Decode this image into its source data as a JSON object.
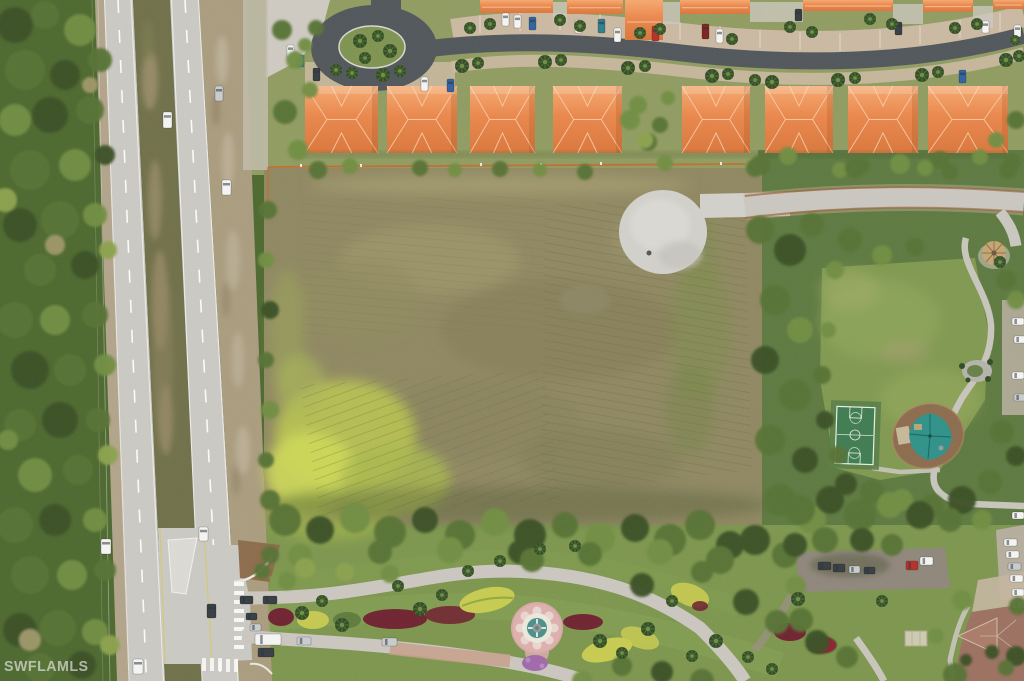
{
  "watermark": {
    "text": "SWFLAMLS"
  },
  "palette": {
    "forest_base": "#4c672f",
    "topland_base": "#8e9a60",
    "lot_base": "#8d8660",
    "park_base": "#5c7840",
    "bottom_base": "#7b944d",
    "hwy": "#c9c7c1",
    "lane": "#ffffff",
    "asphalt": "#50555a",
    "gravel": "#a89a7d",
    "shoulder": "#b0a289",
    "median_veg": "#6e6e49",
    "median_tan": "#a3936f",
    "apron": "#c9b7a0",
    "pave_light": "#ccc8c0",
    "roof_base": "#e8854b",
    "roof_light": "#f4a76e",
    "roof_dark": "#d8753c",
    "ridge": "#f7cda6",
    "lawn": "#7e974f",
    "island_green": "#7d9150",
    "lot_dark": "#7b7752",
    "lot_light": "#9e956c",
    "lot_bright": "#b9c44f",
    "lot_bright2": "#ccd758",
    "pad": "#d0cec9",
    "path": "#c6c3bb",
    "court": "#3f7a50",
    "court_pad": "#587c47",
    "court_line": "#e6eee4",
    "mulch": "#8a6a4d",
    "canopy": "#2f8f87",
    "sand": "#cbbf9f",
    "entr_road": "#c9c5be",
    "paver": "#c59c8a",
    "maroon": "#6e2430",
    "bed_yellow": "#c6c94f",
    "purple": "#9d68a8",
    "flower_red": "#8a2430",
    "fountain_pink": "#dcaeac",
    "fountain_white": "#e9e6da",
    "fountain_teal": "#4a8d88",
    "tile_roof": "#9a6f60",
    "tile_gable": "#a87a68",
    "tile_ridge": "#cfb9a5",
    "gazebo": "#c3a473",
    "dirt": "#8a6a4a",
    "parking_dark": "#8d8579",
    "wedge": "#b3ab9b",
    "silt_fence": "#c8642a",
    "palm_dark": "#2f4a26",
    "palm_light": "#5d7a38",
    "wm": "rgba(225,227,222,0.7)",
    "tree_colors": [
      "#3a5025",
      "#567134",
      "#6f8c43",
      "#8aa04e",
      "#9b9468"
    ]
  },
  "vehicles": {
    "colors": {
      "white": "#f3f3f1",
      "silver": "#c6cacc",
      "dark": "#363c41",
      "blue": "#31609f",
      "teal": "#2d7d8c",
      "red": "#b5302a",
      "maroon": "#7c2320"
    },
    "items": [
      [
        163,
        112,
        9,
        16,
        "white"
      ],
      [
        215,
        86,
        8,
        15,
        "silver"
      ],
      [
        222,
        180,
        9,
        15,
        "white"
      ],
      [
        199,
        527,
        9,
        14,
        "white"
      ],
      [
        101,
        539,
        10,
        15,
        "white"
      ],
      [
        133,
        659,
        10,
        15,
        "white"
      ],
      [
        207,
        604,
        9,
        14,
        "dark"
      ],
      [
        240,
        596,
        13,
        8,
        "dark"
      ],
      [
        246,
        613,
        11,
        7,
        "dark"
      ],
      [
        263,
        596,
        14,
        8,
        "dark"
      ],
      [
        250,
        624,
        11,
        7,
        "silver"
      ],
      [
        255,
        634,
        26,
        11,
        "white"
      ],
      [
        258,
        648,
        16,
        9,
        "dark"
      ],
      [
        297,
        637,
        14,
        8,
        "silver"
      ],
      [
        382,
        638,
        15,
        8,
        "silver"
      ],
      [
        502,
        13,
        7,
        13,
        "white"
      ],
      [
        514,
        15,
        7,
        13,
        "white"
      ],
      [
        529,
        17,
        7,
        13,
        "blue"
      ],
      [
        575,
        20,
        7,
        13,
        "white"
      ],
      [
        598,
        19,
        7,
        14,
        "teal"
      ],
      [
        614,
        28,
        7,
        14,
        "white"
      ],
      [
        652,
        26,
        7,
        15,
        "red"
      ],
      [
        702,
        24,
        7,
        15,
        "maroon"
      ],
      [
        716,
        29,
        7,
        14,
        "white"
      ],
      [
        795,
        9,
        7,
        12,
        "dark"
      ],
      [
        895,
        22,
        7,
        13,
        "dark"
      ],
      [
        982,
        21,
        7,
        12,
        "white"
      ],
      [
        1014,
        25,
        7,
        12,
        "white"
      ],
      [
        421,
        77,
        7,
        14,
        "white"
      ],
      [
        447,
        79,
        7,
        13,
        "blue"
      ],
      [
        313,
        68,
        7,
        13,
        "dark"
      ],
      [
        959,
        70,
        7,
        13,
        "blue"
      ],
      [
        287,
        45,
        7,
        12,
        "white"
      ],
      [
        297,
        55,
        7,
        12,
        "teal"
      ],
      [
        818,
        562,
        13,
        8,
        "dark"
      ],
      [
        833,
        564,
        12,
        8,
        "dark"
      ],
      [
        849,
        566,
        11,
        7,
        "silver"
      ],
      [
        864,
        567,
        11,
        7,
        "dark"
      ],
      [
        906,
        561,
        12,
        9,
        "red"
      ],
      [
        920,
        557,
        13,
        8,
        "white"
      ],
      [
        1004,
        539,
        13,
        7,
        "white"
      ],
      [
        1006,
        551,
        13,
        7,
        "white"
      ],
      [
        1008,
        563,
        13,
        7,
        "silver"
      ],
      [
        1010,
        575,
        13,
        7,
        "white"
      ],
      [
        1012,
        589,
        12,
        7,
        "white"
      ],
      [
        1013,
        601,
        12,
        7,
        "white"
      ],
      [
        1012,
        512,
        12,
        7,
        "white"
      ],
      [
        1012,
        318,
        12,
        7,
        "white"
      ],
      [
        1014,
        336,
        12,
        7,
        "white"
      ],
      [
        1012,
        372,
        12,
        7,
        "white"
      ],
      [
        1014,
        394,
        12,
        7,
        "silver"
      ]
    ]
  },
  "buildings": {
    "main_row": {
      "y": 86,
      "h": 67,
      "items": [
        [
          305,
          73
        ],
        [
          387,
          70
        ],
        [
          470,
          65
        ],
        [
          553,
          69
        ],
        [
          682,
          68
        ],
        [
          765,
          68
        ],
        [
          848,
          70
        ],
        [
          928,
          80
        ]
      ]
    },
    "top_row": [
      [
        480,
        0,
        73,
        13
      ],
      [
        567,
        0,
        56,
        14
      ],
      [
        625,
        0,
        38,
        40
      ],
      [
        680,
        0,
        70,
        14
      ],
      [
        803,
        0,
        90,
        11
      ],
      [
        923,
        0,
        50,
        12
      ],
      [
        993,
        0,
        31,
        9
      ]
    ]
  },
  "trees": [
    [
      15,
      25,
      18,
      0
    ],
    [
      45,
      15,
      14,
      1
    ],
    [
      80,
      30,
      16,
      2
    ],
    [
      25,
      70,
      20,
      1
    ],
    [
      65,
      75,
      15,
      0
    ],
    [
      100,
      60,
      12,
      1
    ],
    [
      15,
      120,
      16,
      2
    ],
    [
      50,
      115,
      18,
      0
    ],
    [
      90,
      110,
      14,
      1
    ],
    [
      30,
      170,
      20,
      1
    ],
    [
      75,
      165,
      16,
      2
    ],
    [
      105,
      155,
      10,
      0
    ],
    [
      20,
      225,
      17,
      0
    ],
    [
      60,
      220,
      19,
      1
    ],
    [
      95,
      215,
      12,
      2
    ],
    [
      40,
      270,
      16,
      1
    ],
    [
      85,
      265,
      14,
      0
    ],
    [
      55,
      245,
      10,
      4
    ],
    [
      15,
      320,
      18,
      1
    ],
    [
      55,
      320,
      15,
      2
    ],
    [
      95,
      315,
      13,
      1
    ],
    [
      30,
      370,
      19,
      0
    ],
    [
      70,
      370,
      16,
      1
    ],
    [
      105,
      365,
      11,
      2
    ],
    [
      20,
      425,
      16,
      1
    ],
    [
      60,
      420,
      18,
      0
    ],
    [
      98,
      420,
      12,
      1
    ],
    [
      35,
      475,
      17,
      2
    ],
    [
      78,
      470,
      15,
      1
    ],
    [
      15,
      525,
      18,
      1
    ],
    [
      55,
      520,
      16,
      0
    ],
    [
      95,
      520,
      12,
      2
    ],
    [
      30,
      575,
      19,
      1
    ],
    [
      72,
      575,
      15,
      2
    ],
    [
      105,
      570,
      11,
      1
    ],
    [
      20,
      630,
      17,
      0
    ],
    [
      58,
      628,
      18,
      1
    ],
    [
      95,
      632,
      13,
      2
    ],
    [
      40,
      668,
      15,
      1
    ],
    [
      82,
      665,
      14,
      0
    ],
    [
      30,
      640,
      11,
      4
    ],
    [
      90,
      85,
      8,
      4
    ],
    [
      108,
      250,
      9,
      3
    ],
    [
      108,
      455,
      10,
      3
    ],
    [
      5,
      200,
      12,
      3
    ],
    [
      8,
      440,
      10,
      2
    ],
    [
      110,
      645,
      10,
      3
    ],
    [
      285,
      112,
      12,
      1
    ],
    [
      298,
      150,
      10,
      2
    ],
    [
      318,
      170,
      9,
      1
    ],
    [
      350,
      166,
      8,
      2
    ],
    [
      420,
      168,
      8,
      1
    ],
    [
      455,
      170,
      7,
      2
    ],
    [
      500,
      169,
      8,
      1
    ],
    [
      540,
      170,
      7,
      2
    ],
    [
      585,
      172,
      8,
      1
    ],
    [
      630,
      120,
      10,
      2
    ],
    [
      648,
      142,
      9,
      1
    ],
    [
      665,
      163,
      8,
      2
    ],
    [
      755,
      168,
      9,
      1
    ],
    [
      840,
      170,
      8,
      2
    ],
    [
      862,
      166,
      8,
      1
    ],
    [
      925,
      168,
      8,
      2
    ],
    [
      1008,
      170,
      9,
      1
    ],
    [
      950,
      172,
      8,
      1
    ],
    [
      295,
      60,
      9,
      2
    ],
    [
      282,
      30,
      10,
      1
    ],
    [
      310,
      90,
      8,
      2
    ],
    [
      316,
      28,
      8,
      1
    ],
    [
      305,
      45,
      7,
      2
    ],
    [
      638,
      105,
      9,
      2
    ],
    [
      660,
      125,
      8,
      1
    ],
    [
      645,
      140,
      8,
      3
    ],
    [
      668,
      98,
      7,
      2
    ],
    [
      760,
      230,
      14,
      1
    ],
    [
      790,
      250,
      16,
      0
    ],
    [
      812,
      225,
      12,
      1
    ],
    [
      775,
      300,
      15,
      1
    ],
    [
      800,
      330,
      13,
      2
    ],
    [
      765,
      360,
      14,
      0
    ],
    [
      795,
      395,
      16,
      1
    ],
    [
      770,
      440,
      15,
      1
    ],
    [
      805,
      460,
      13,
      0
    ],
    [
      780,
      500,
      16,
      1
    ],
    [
      812,
      520,
      14,
      2
    ],
    [
      760,
      165,
      10,
      1
    ],
    [
      788,
      156,
      9,
      2
    ],
    [
      855,
      168,
      10,
      1
    ],
    [
      900,
      164,
      10,
      2
    ],
    [
      940,
      160,
      9,
      1
    ],
    [
      980,
      157,
      8,
      2
    ],
    [
      1012,
      162,
      9,
      1
    ],
    [
      850,
      240,
      12,
      1
    ],
    [
      882,
      255,
      10,
      2
    ],
    [
      915,
      247,
      9,
      1
    ],
    [
      835,
      270,
      9,
      2
    ],
    [
      1016,
      120,
      9,
      1
    ],
    [
      996,
      140,
      8,
      2
    ],
    [
      1006,
      280,
      10,
      1
    ],
    [
      1016,
      300,
      9,
      2
    ],
    [
      1002,
      432,
      12,
      1
    ],
    [
      1016,
      456,
      10,
      0
    ],
    [
      990,
      482,
      12,
      1
    ],
    [
      962,
      500,
      14,
      0
    ],
    [
      932,
      506,
      12,
      1
    ],
    [
      902,
      500,
      11,
      2
    ],
    [
      872,
      492,
      12,
      1
    ],
    [
      846,
      484,
      11,
      0
    ],
    [
      828,
      330,
      8,
      2
    ],
    [
      822,
      375,
      9,
      1
    ],
    [
      825,
      420,
      9,
      0
    ],
    [
      838,
      455,
      9,
      1
    ],
    [
      285,
      520,
      16,
      1
    ],
    [
      320,
      530,
      14,
      0
    ],
    [
      355,
      518,
      15,
      2
    ],
    [
      390,
      532,
      16,
      1
    ],
    [
      425,
      520,
      13,
      0
    ],
    [
      460,
      535,
      15,
      1
    ],
    [
      495,
      522,
      14,
      2
    ],
    [
      530,
      535,
      16,
      0
    ],
    [
      565,
      525,
      13,
      1
    ],
    [
      600,
      538,
      15,
      2
    ],
    [
      635,
      528,
      14,
      0
    ],
    [
      670,
      540,
      16,
      1
    ],
    [
      700,
      525,
      15,
      1
    ],
    [
      730,
      545,
      14,
      0
    ],
    [
      300,
      556,
      12,
      2
    ],
    [
      380,
      552,
      12,
      1
    ],
    [
      450,
      550,
      13,
      2
    ],
    [
      520,
      552,
      12,
      0
    ],
    [
      590,
      554,
      12,
      1
    ],
    [
      660,
      552,
      13,
      2
    ],
    [
      720,
      560,
      14,
      1
    ],
    [
      755,
      540,
      15,
      0
    ],
    [
      785,
      555,
      13,
      1
    ],
    [
      305,
      568,
      10,
      3
    ],
    [
      345,
      572,
      9,
      3
    ],
    [
      390,
      574,
      9,
      2
    ],
    [
      270,
      555,
      9,
      1
    ],
    [
      268,
      210,
      9,
      1
    ],
    [
      266,
      260,
      8,
      2
    ],
    [
      270,
      310,
      9,
      0
    ],
    [
      266,
      360,
      8,
      1
    ],
    [
      270,
      410,
      9,
      2
    ],
    [
      266,
      460,
      8,
      1
    ],
    [
      270,
      500,
      10,
      1
    ],
    [
      800,
      510,
      15,
      1
    ],
    [
      830,
      500,
      14,
      0
    ],
    [
      860,
      515,
      16,
      1
    ],
    [
      890,
      505,
      13,
      2
    ],
    [
      920,
      515,
      14,
      0
    ],
    [
      950,
      520,
      12,
      1
    ],
    [
      795,
      545,
      12,
      0
    ],
    [
      825,
      540,
      13,
      1
    ],
    [
      982,
      520,
      10,
      2
    ],
    [
      862,
      540,
      12,
      0
    ],
    [
      892,
      545,
      11,
      1
    ],
    [
      796,
      586,
      10,
      2
    ],
    [
      801,
      620,
      12,
      1
    ],
    [
      962,
      600,
      10,
      2
    ],
    [
      955,
      675,
      12,
      1
    ],
    [
      1016,
      656,
      10,
      0
    ],
    [
      936,
      636,
      8,
      2
    ],
    [
      1018,
      606,
      9,
      1
    ],
    [
      992,
      652,
      7,
      0
    ],
    [
      1006,
      668,
      8,
      1
    ],
    [
      966,
      660,
      6,
      0
    ],
    [
      532,
      560,
      12,
      1
    ],
    [
      642,
      585,
      12,
      0
    ],
    [
      702,
      572,
      11,
      1
    ],
    [
      746,
      602,
      13,
      0
    ],
    [
      777,
      622,
      12,
      1
    ],
    [
      817,
      642,
      12,
      0
    ],
    [
      847,
      657,
      11,
      1
    ],
    [
      702,
      681,
      12,
      1
    ],
    [
      662,
      672,
      11,
      0
    ],
    [
      622,
      666,
      10,
      1
    ],
    [
      582,
      681,
      10,
      2
    ],
    [
      287,
      581,
      9,
      2
    ],
    [
      262,
      571,
      8,
      1
    ]
  ],
  "palms": [
    [
      383,
      75,
      7
    ],
    [
      400,
      71,
      6
    ],
    [
      462,
      66,
      7
    ],
    [
      478,
      63,
      6
    ],
    [
      545,
      62,
      7
    ],
    [
      561,
      60,
      6
    ],
    [
      628,
      68,
      7
    ],
    [
      645,
      66,
      6
    ],
    [
      712,
      76,
      7
    ],
    [
      728,
      74,
      6
    ],
    [
      755,
      80,
      6
    ],
    [
      772,
      82,
      7
    ],
    [
      838,
      80,
      7
    ],
    [
      855,
      78,
      6
    ],
    [
      922,
      75,
      7
    ],
    [
      938,
      72,
      6
    ],
    [
      1006,
      60,
      7
    ],
    [
      1019,
      56,
      6
    ],
    [
      352,
      73,
      6
    ],
    [
      336,
      70,
      6
    ],
    [
      360,
      41,
      7
    ],
    [
      378,
      36,
      6
    ],
    [
      390,
      51,
      7
    ],
    [
      365,
      58,
      6
    ],
    [
      470,
      28,
      6
    ],
    [
      490,
      24,
      6
    ],
    [
      560,
      20,
      6
    ],
    [
      580,
      26,
      6
    ],
    [
      640,
      33,
      6
    ],
    [
      660,
      29,
      6
    ],
    [
      732,
      39,
      6
    ],
    [
      790,
      27,
      6
    ],
    [
      812,
      32,
      6
    ],
    [
      870,
      19,
      6
    ],
    [
      892,
      24,
      6
    ],
    [
      955,
      28,
      6
    ],
    [
      977,
      24,
      6
    ],
    [
      1015,
      40,
      5
    ],
    [
      302,
      613,
      7
    ],
    [
      322,
      601,
      6
    ],
    [
      342,
      625,
      7
    ],
    [
      420,
      609,
      7
    ],
    [
      442,
      595,
      6
    ],
    [
      468,
      571,
      6
    ],
    [
      398,
      586,
      6
    ],
    [
      600,
      641,
      7
    ],
    [
      622,
      653,
      6
    ],
    [
      648,
      629,
      7
    ],
    [
      672,
      601,
      6
    ],
    [
      692,
      656,
      6
    ],
    [
      716,
      641,
      7
    ],
    [
      748,
      657,
      6
    ],
    [
      772,
      669,
      6
    ],
    [
      500,
      561,
      6
    ],
    [
      540,
      549,
      6
    ],
    [
      575,
      546,
      6
    ],
    [
      798,
      599,
      7
    ],
    [
      882,
      601,
      6
    ],
    [
      1000,
      262,
      6
    ]
  ]
}
